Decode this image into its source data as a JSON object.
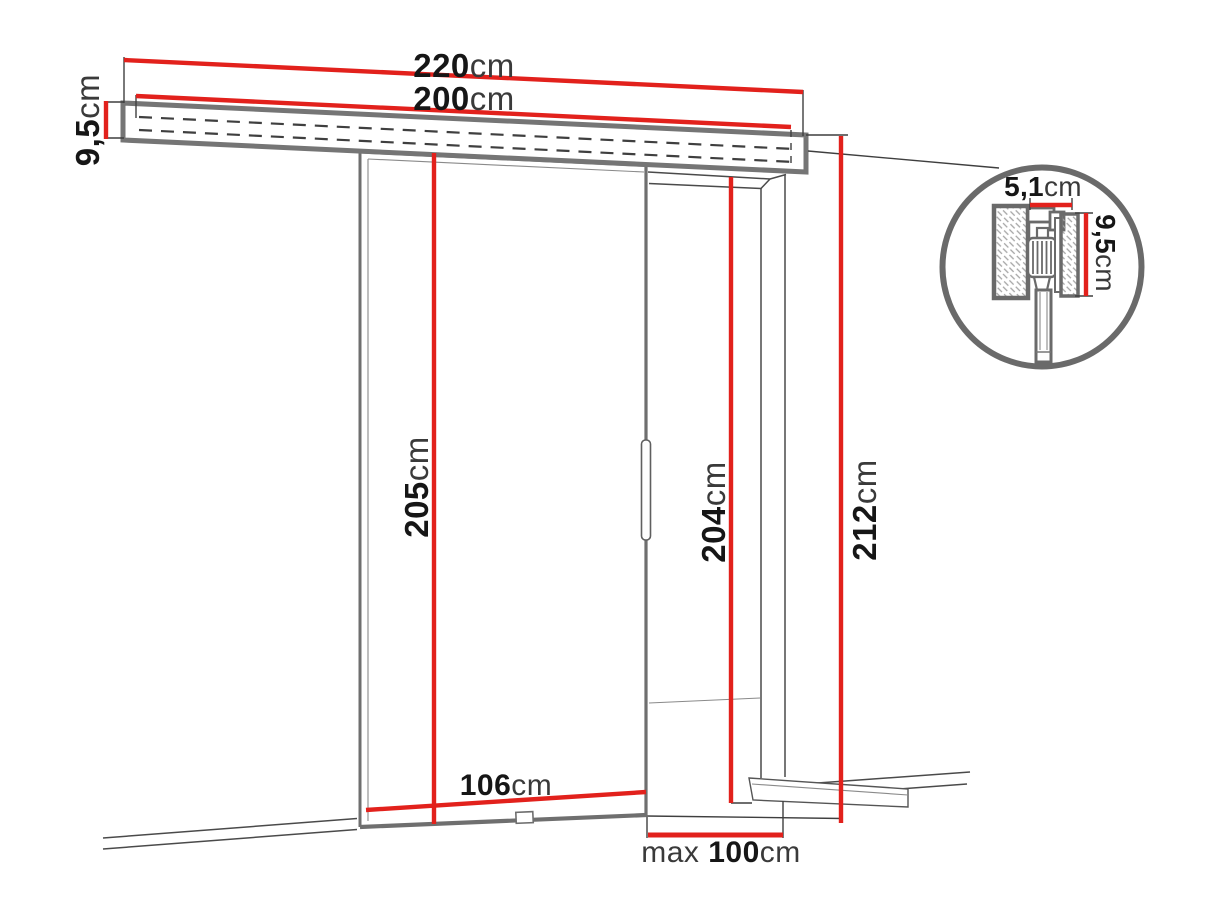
{
  "diagram_title": "sliding-door-dimension-drawing",
  "colors": {
    "dimension_red": "#e2211c",
    "outline_gray": "#757575",
    "thin_line": "#3f3f3f",
    "text_dark": "#161616",
    "text_unit": "#3a3a3a",
    "background": "#ffffff"
  },
  "dims": {
    "d220": {
      "value": "220",
      "unit": "cm"
    },
    "d200": {
      "value": "200",
      "unit": "cm"
    },
    "d95_left": {
      "value": "9,5",
      "unit": "cm"
    },
    "d205": {
      "value": "205",
      "unit": "cm"
    },
    "d204": {
      "value": "204",
      "unit": "cm"
    },
    "d212": {
      "value": "212",
      "unit": "cm"
    },
    "d106": {
      "value": "106",
      "unit": "cm"
    },
    "d100": {
      "prefix": "max ",
      "value": "100",
      "unit": "cm"
    },
    "detail_width": {
      "value": "5,1",
      "unit": "cm"
    },
    "detail_height": {
      "value": "9,5",
      "unit": "cm"
    }
  }
}
